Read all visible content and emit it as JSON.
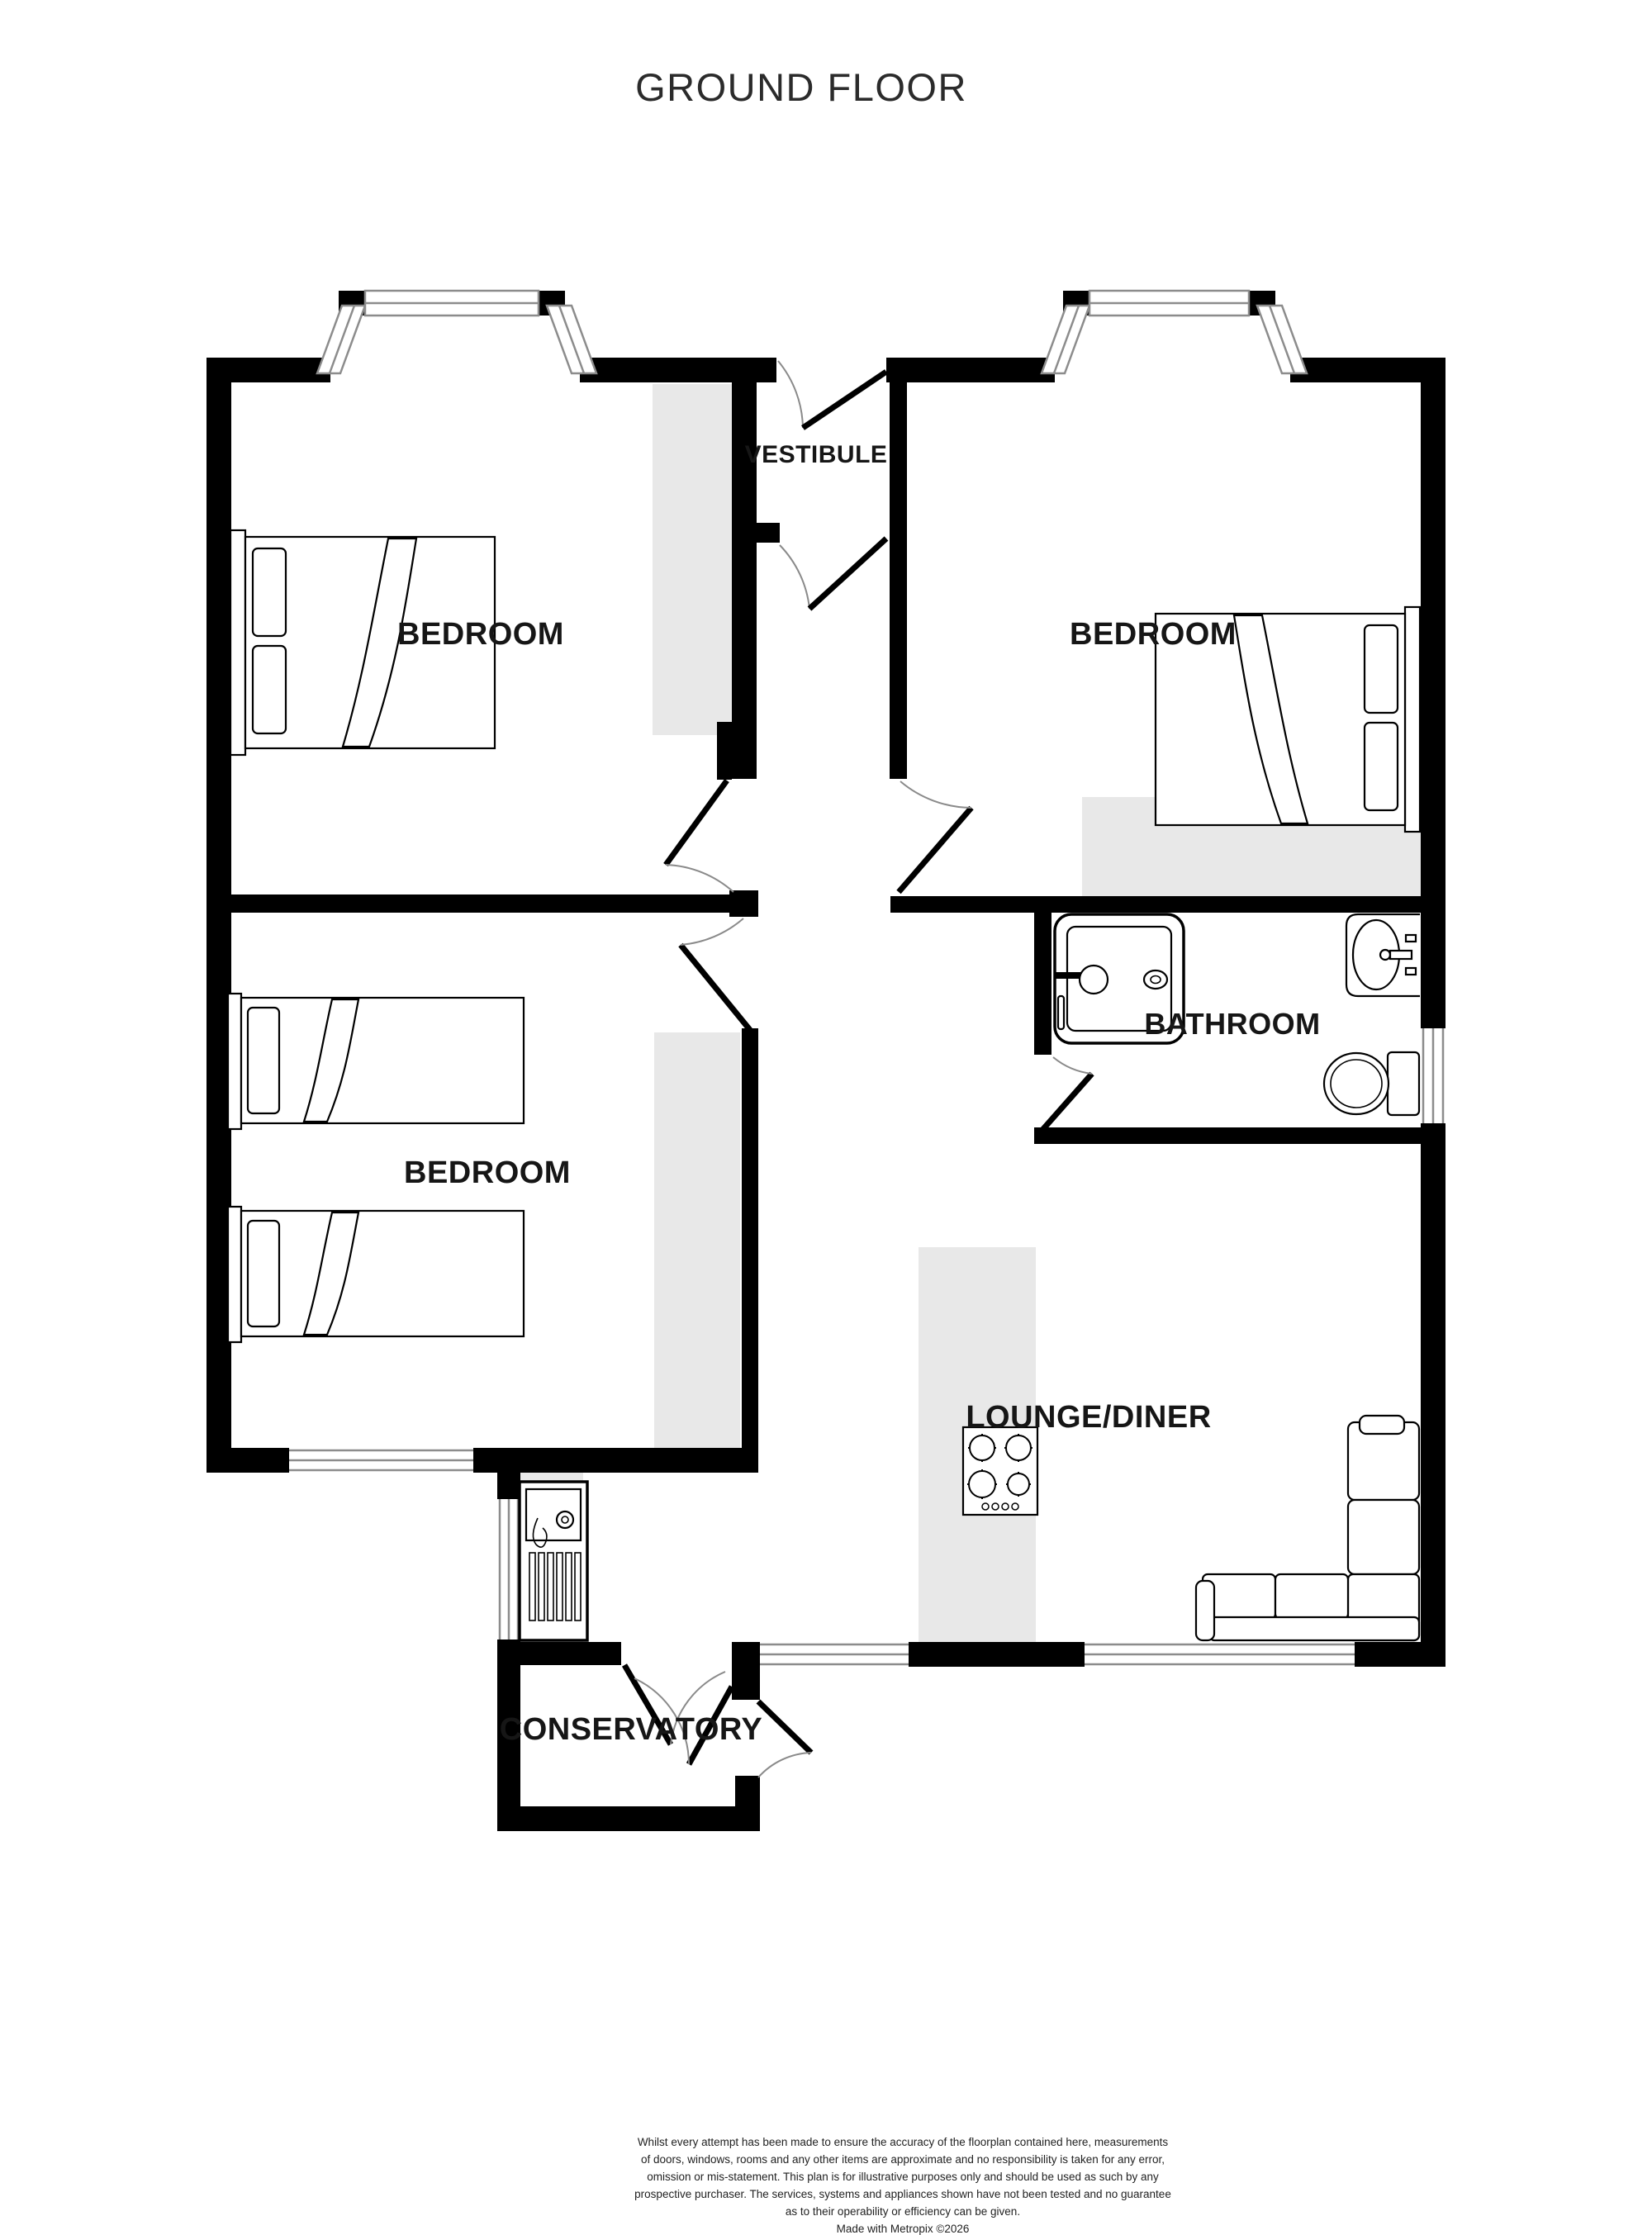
{
  "title": "GROUND FLOOR",
  "rooms": {
    "vestibule": {
      "label": "VESTIBULE"
    },
    "bedroom_top_left": {
      "label": "BEDROOM"
    },
    "bedroom_top_right": {
      "label": "BEDROOM"
    },
    "bedroom_bottom_left": {
      "label": "BEDROOM"
    },
    "bathroom": {
      "label": "BATHROOM"
    },
    "lounge_diner": {
      "label": "LOUNGE/DINER"
    },
    "conservatory": {
      "label": "CONSERVATORY"
    }
  },
  "furniture_icons": [
    "double-bed-icon",
    "double-bed-icon",
    "single-bed-icon",
    "single-bed-icon",
    "shower-icon",
    "wash-basin-icon",
    "toilet-icon",
    "kitchen-sink-icon",
    "gas-hob-icon",
    "corner-sofa-icon"
  ],
  "colors": {
    "wall": "#000000",
    "background": "#ffffff",
    "storage_shading": "#e8e8e8",
    "window_frame": "#8c8c8c",
    "door_arc": "#8a8a8a",
    "label_text": "#161616"
  },
  "disclaimer": {
    "lines": [
      "Whilst every attempt has been made to ensure the accuracy of the floorplan contained here, measurements",
      "of doors, windows, rooms and any other items are approximate and no responsibility is taken for any error,",
      "omission or mis-statement. This plan is for illustrative purposes only and should be used as such by any",
      "prospective purchaser. The services, systems and appliances shown have not been tested and no guarantee",
      "as to their operability or efficiency can be given."
    ],
    "credit": "Made with Metropix ©2026"
  }
}
